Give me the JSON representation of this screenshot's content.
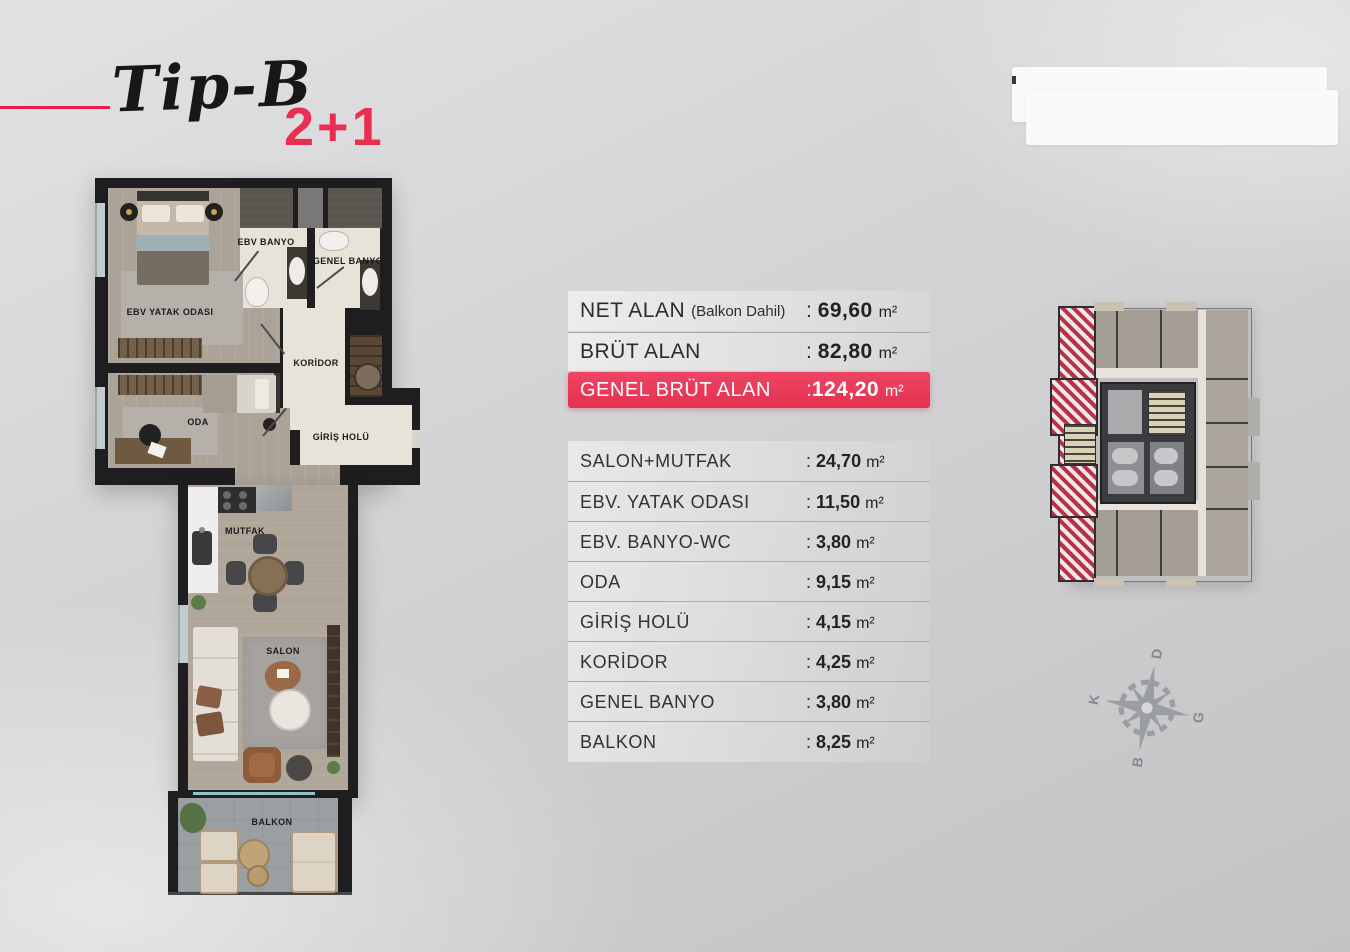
{
  "header": {
    "script_title": "Tip-B",
    "unit_type": "2+1",
    "accent_color": "#ec1a4d"
  },
  "punct": {
    "colon": ":"
  },
  "summary_table": {
    "highlight_color": "#e93a5a",
    "rows": [
      {
        "label": "NET ALAN",
        "note": "(Balkon Dahil)",
        "value": "69,60",
        "unit": "m²"
      },
      {
        "label": "BRÜT ALAN",
        "note": "",
        "value": "82,80",
        "unit": "m²"
      },
      {
        "label": "GENEL BRÜT ALAN",
        "note": "",
        "value": "124,20",
        "unit": "m²"
      }
    ]
  },
  "room_table": {
    "rows": [
      {
        "label": "SALON+MUTFAK",
        "value": "24,70",
        "unit": "m²"
      },
      {
        "label": "EBV. YATAK ODASI",
        "value": "11,50",
        "unit": "m²"
      },
      {
        "label": "EBV. BANYO-WC",
        "value": "3,80",
        "unit": "m²"
      },
      {
        "label": "ODA",
        "value": "9,15",
        "unit": "m²"
      },
      {
        "label": "GİRİŞ HOLÜ",
        "value": "4,15",
        "unit": "m²"
      },
      {
        "label": "KORİDOR",
        "value": "4,25",
        "unit": "m²"
      },
      {
        "label": "GENEL BANYO",
        "value": "3,80",
        "unit": "m²"
      },
      {
        "label": "BALKON",
        "value": "8,25",
        "unit": "m²"
      }
    ]
  },
  "floor_plan": {
    "labels": {
      "master_bedroom": "EBV YATAK ODASI",
      "room": "ODA",
      "master_bath": "EBV BANYO",
      "general_bath": "GENEL BANYO",
      "corridor": "KORİDOR",
      "entrance_hall": "GİRİŞ HOLÜ",
      "kitchen": "MUTFAK",
      "living_room": "SALON",
      "balcony": "BALKON"
    }
  },
  "key_plan": {
    "highlight_color": "#b53249"
  },
  "compass": {
    "north": "K",
    "east": "D",
    "south": "G",
    "west": "B"
  }
}
